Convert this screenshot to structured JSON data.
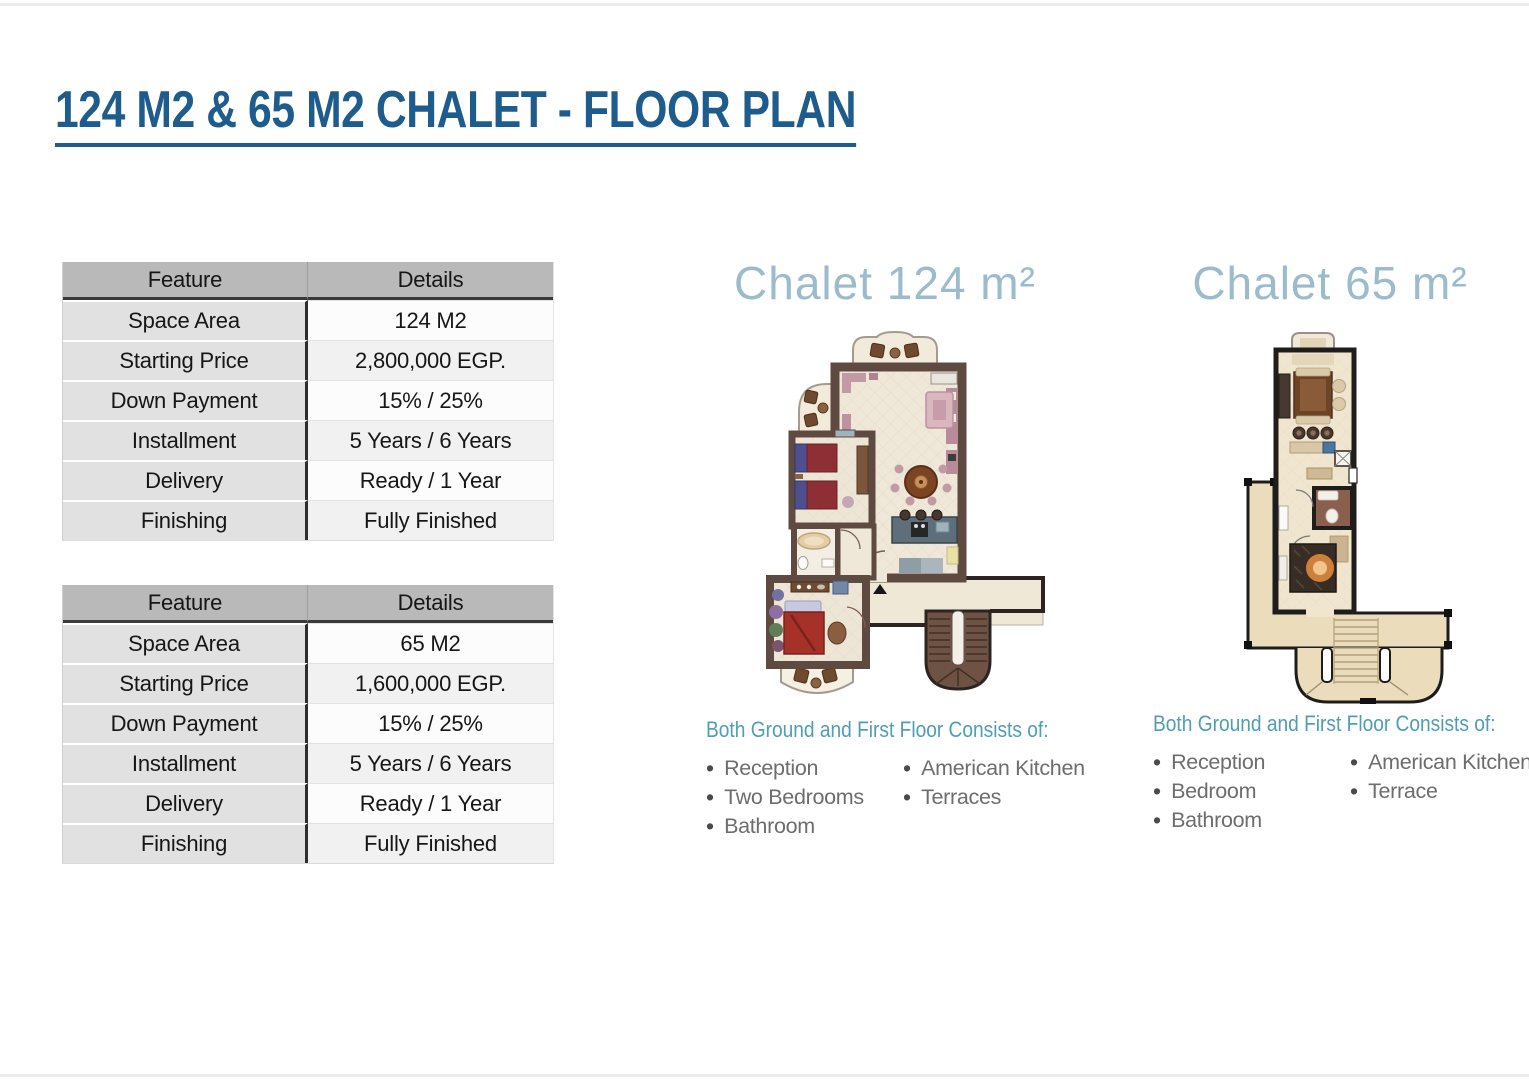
{
  "page": {
    "title": "124 M2 & 65 M2 CHALET - FLOOR PLAN"
  },
  "colors": {
    "title_blue": "#1E5C8D",
    "plan_title_blue": "#9CBBCB",
    "consists_heading_teal": "#4F9EB6",
    "list_text_gray": "#6D6D6D",
    "table_header_gray": "#B9B9B9",
    "table_feature_gray": "#E1E1E1",
    "wall_brown": "#5F4A41",
    "wall_black": "#1F1D1B",
    "floor_beige": "#F0E5CF"
  },
  "icons": {
    "bullet": "•"
  },
  "tables": [
    {
      "name": "chalet-124-pricing",
      "headers": [
        "Feature",
        "Details"
      ],
      "rows": [
        [
          "Space Area",
          "124 M2"
        ],
        [
          "Starting Price",
          "2,800,000 EGP."
        ],
        [
          "Down Payment",
          "15% / 25%"
        ],
        [
          "Installment",
          "5 Years / 6 Years"
        ],
        [
          "Delivery",
          "Ready / 1 Year"
        ],
        [
          "Finishing",
          "Fully Finished"
        ]
      ]
    },
    {
      "name": "chalet-65-pricing",
      "headers": [
        "Feature",
        "Details"
      ],
      "rows": [
        [
          "Space Area",
          "65 M2"
        ],
        [
          "Starting Price",
          "1,600,000 EGP."
        ],
        [
          "Down Payment",
          "15% / 25%"
        ],
        [
          "Installment",
          "5 Years / 6 Years"
        ],
        [
          "Delivery",
          "Ready / 1 Year"
        ],
        [
          "Finishing",
          "Fully Finished"
        ]
      ]
    }
  ],
  "plans": [
    {
      "title": "Chalet 124 m²",
      "consists_heading": "Both Ground and First Floor Consists of:",
      "items_col1": [
        "Reception",
        "Two Bedrooms",
        "Bathroom"
      ],
      "items_col2": [
        "American Kitchen",
        "Terraces"
      ]
    },
    {
      "title": "Chalet 65 m²",
      "consists_heading": "Both Ground and First Floor Consists of:",
      "items_col1": [
        "Reception",
        "Bedroom",
        "Bathroom"
      ],
      "items_col2": [
        "American Kitchen",
        "Terrace"
      ]
    }
  ]
}
